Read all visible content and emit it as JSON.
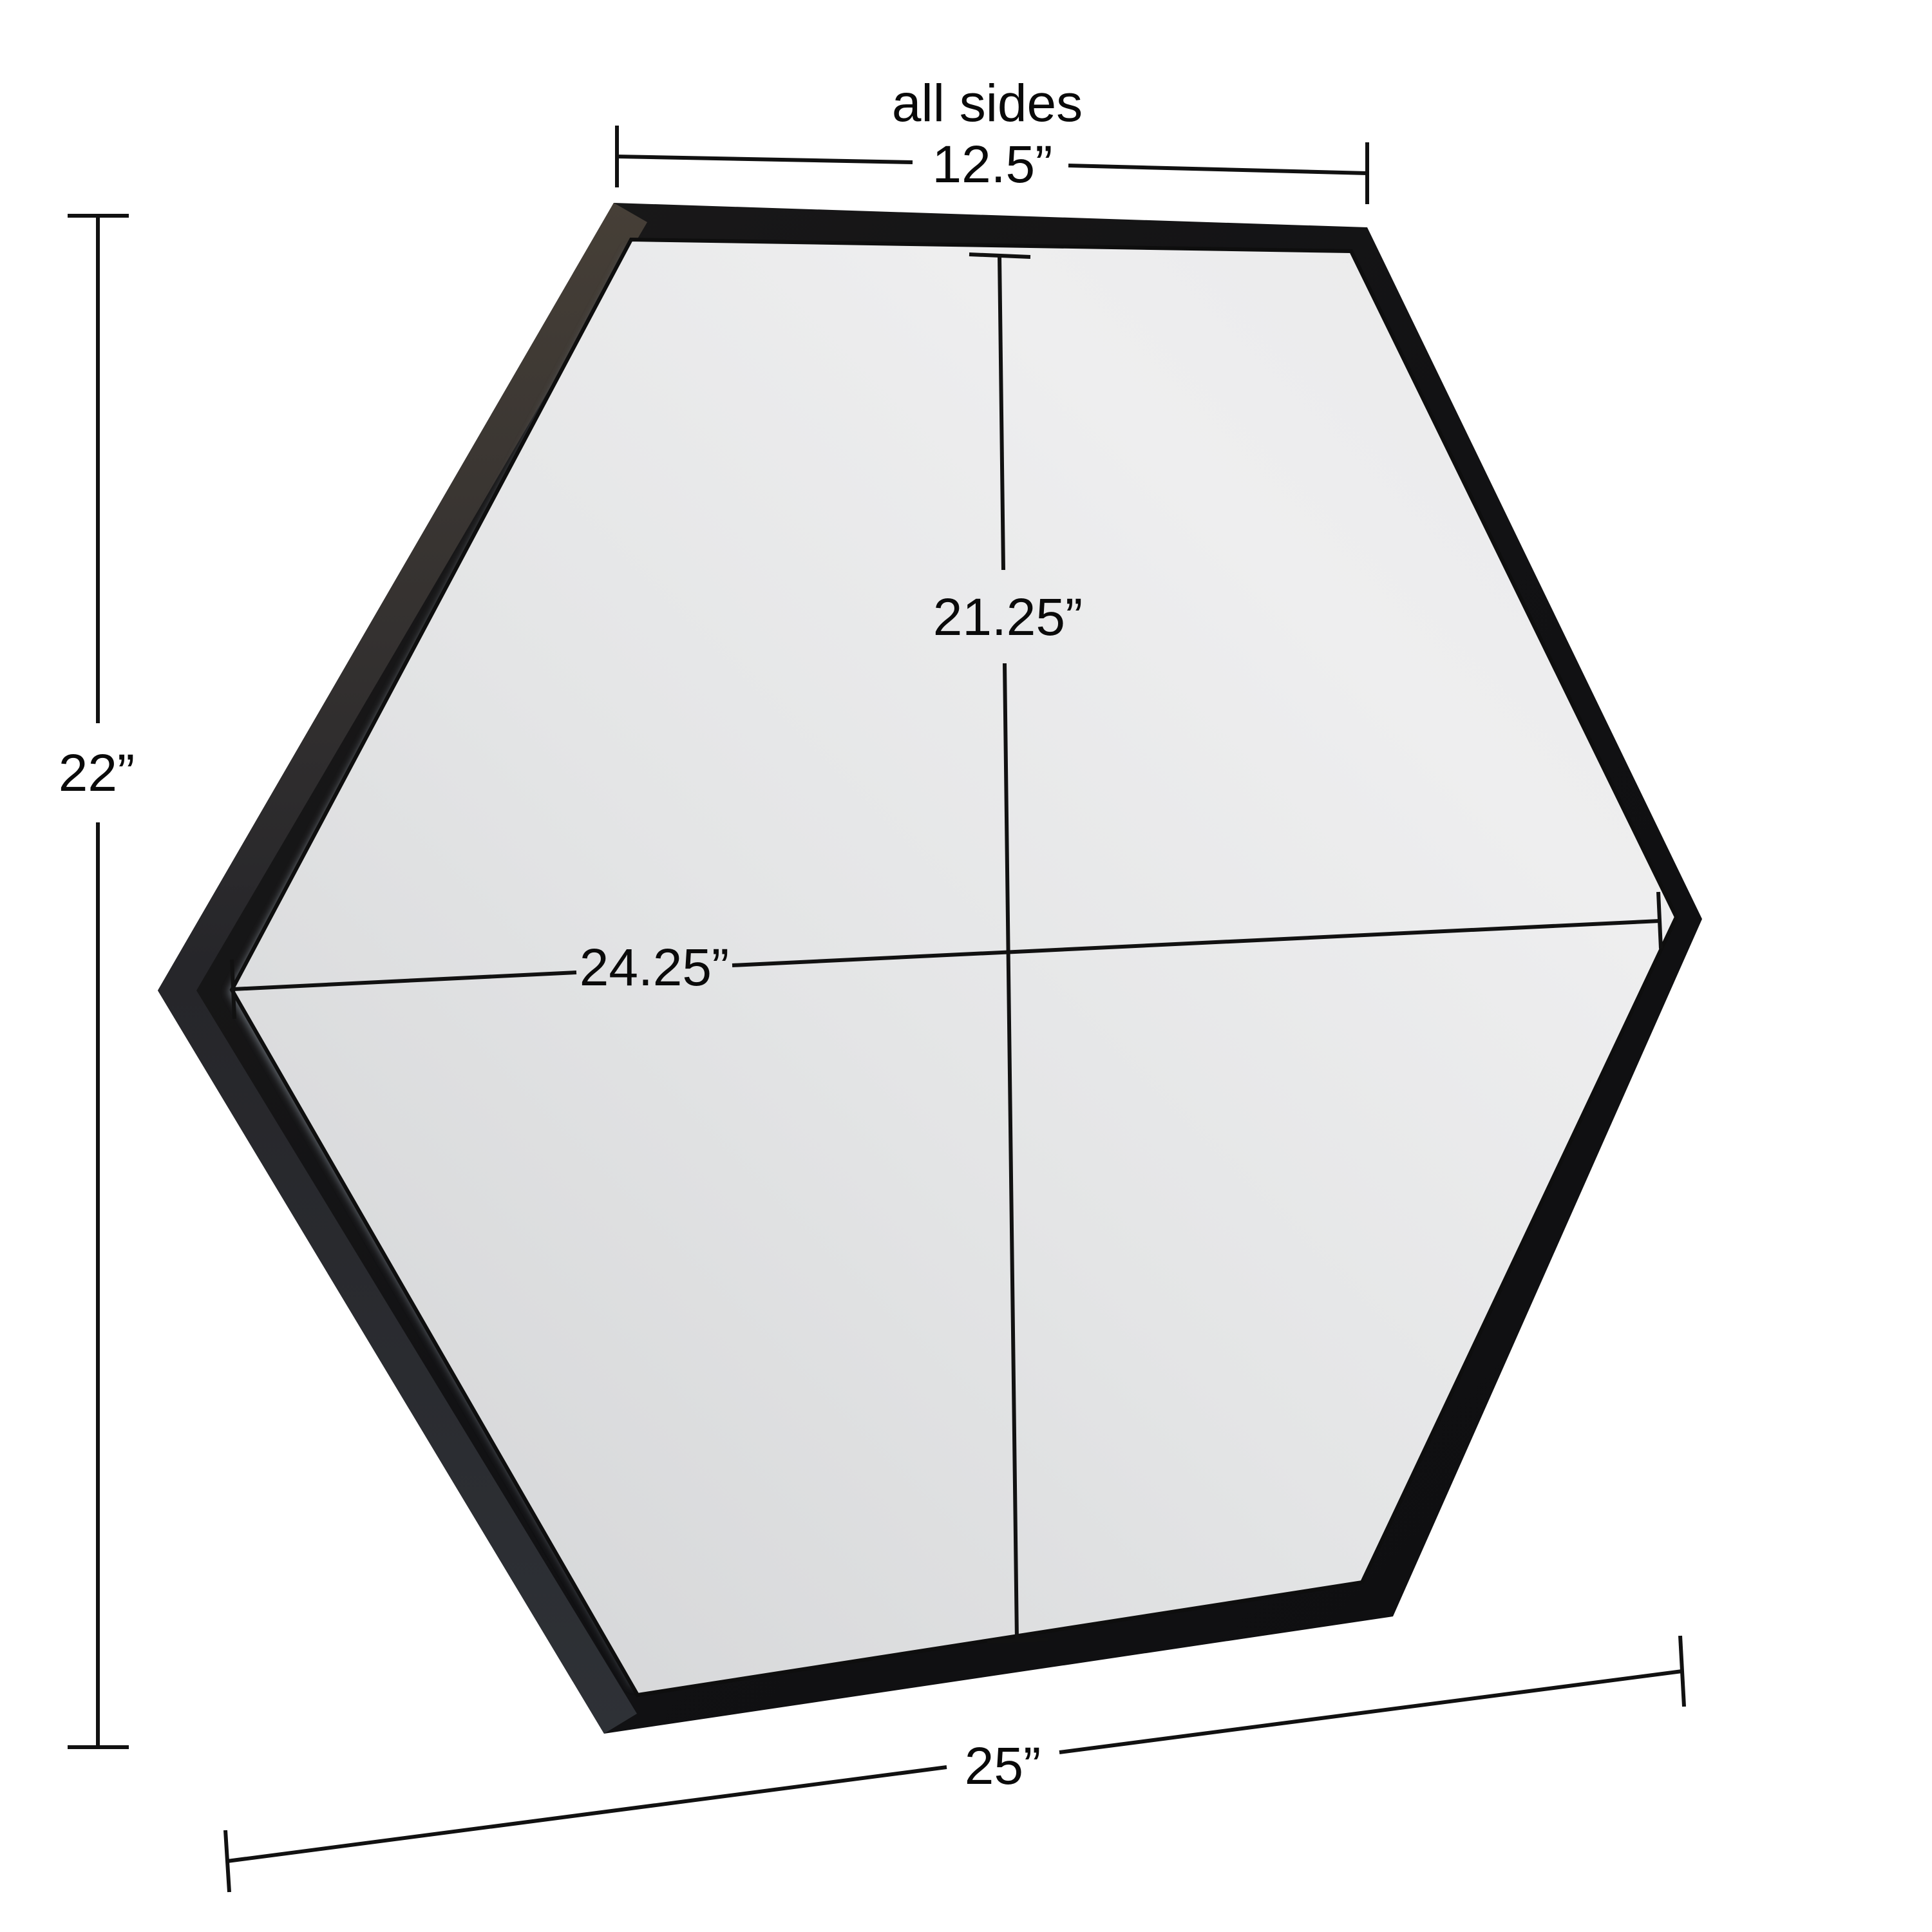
{
  "diagram": {
    "subject": "hexagon wall mirror with black metal frame, dimension diagram",
    "background_color": "#ffffff",
    "frame_color": "#141416",
    "frame_side_color": "#3f3933",
    "mirror_color": "#e6e7e8",
    "annotation_line_color": "#111111",
    "labels": {
      "side_caption": "all sides",
      "side_length": "12.5”",
      "overall_height": "22”",
      "overall_width": "25”",
      "inner_height": "21.25”",
      "inner_width": "24.25”"
    }
  }
}
